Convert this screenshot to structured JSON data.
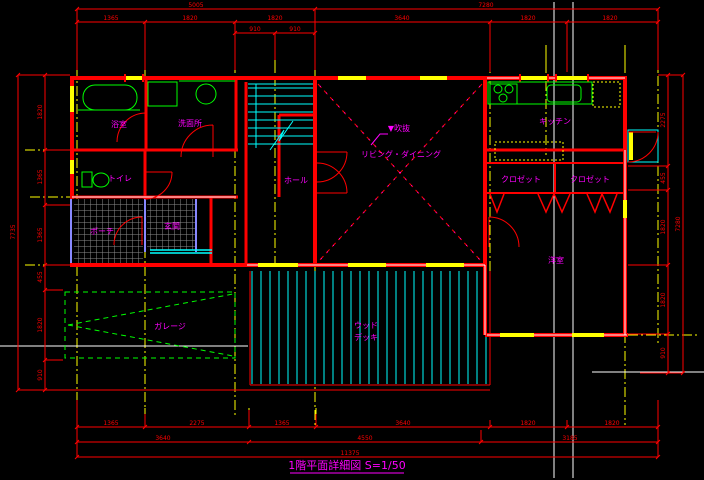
{
  "drawing": {
    "title": "1階平面詳細図 S=1/50"
  },
  "rooms": {
    "bath": "浴室",
    "washroom": "洗面所",
    "toilet": "トイレ",
    "porch": "ポーチ",
    "entrance": "玄関",
    "hall": "ホール",
    "void_marker": "▼吹抜",
    "living_dining": "リビング・ダイニング",
    "kitchen": "キッチン",
    "closet_left": "クロゼット",
    "closet_right": "クロゼット",
    "bedroom": "洋室",
    "deck_line1": "ウッド",
    "deck_line2": "デッキ",
    "garage": "ガレージ"
  },
  "dimensions": {
    "top_total": [
      "5005",
      "7280"
    ],
    "top_row": [
      "1365",
      "1820",
      "1820",
      "3640",
      "1820",
      "1820"
    ],
    "top_sub": [
      "910",
      "910"
    ],
    "bottom_row1": [
      "1365",
      "2275",
      "1365",
      "3640",
      "1820",
      "1820"
    ],
    "bottom_row2": [
      "3640",
      "4550",
      "3185"
    ],
    "bottom_total": "11375",
    "left_row": [
      "1820",
      "1365",
      "1365",
      "455",
      "1820",
      "910"
    ],
    "left_total": "7735",
    "right_row": [
      "2275",
      "455",
      "1820",
      "1820",
      "910"
    ],
    "right_total": "7280"
  },
  "colors": {
    "background": "#000000",
    "dimension": "#ff0000",
    "grid": "#ffff00",
    "wall": "#ff0000",
    "wall_core": "#ffffff",
    "fixture": "#00ff00",
    "stair": "#00ffff",
    "label": "#ff00ff",
    "hatch": "#8c8c8c",
    "door_frame": "#8888ff",
    "boundary": "#ffffff"
  }
}
